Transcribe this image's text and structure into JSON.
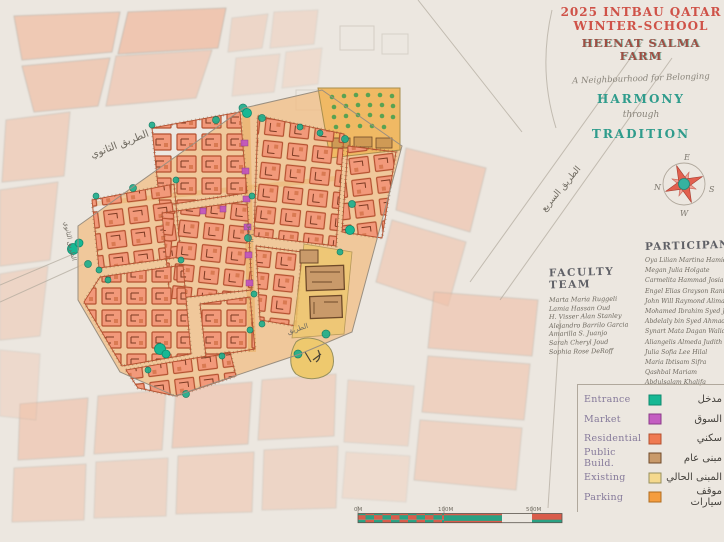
{
  "title_block": {
    "line1": "2025 INTBAU QATAR",
    "line2": "WINTER-SCHOOL",
    "line3": "HEENAT SALMA FARM",
    "dedication": "A Neighbourhood for Belonging",
    "harmony": "HARMONY",
    "through": "through",
    "tradition": "TRADITION"
  },
  "compass": {
    "n": "N",
    "e": "E",
    "s": "S",
    "w": "W"
  },
  "faculty_team": {
    "heading": "FACULTY TEAM",
    "names": [
      "Marta Maria Ruggeli",
      "Lamia Hassan Oud",
      "H. Visser Alan Stanley",
      "Alejandro Barrilo Garcia",
      "Amarilla S. Juanjo",
      "Sarah Cheryl Joud",
      "Sophia Rose DeRoff"
    ]
  },
  "participants": {
    "heading": "PARTICIPANTS",
    "names": [
      "Oya Lilian Martina Hamida",
      "Megan Julia Holgate",
      "Carmelita Hammad Josiane",
      "Engel Elias Grayson Rania",
      "John Will Raymond Alimara",
      "Mohamed Ibrahim Syed Jamil",
      "Abdelaly bin Syed Ahmad",
      "Synart Mata Dagan Walid",
      "Aliangelis Almeda Judith",
      "Julia Sofia Lee Hilal",
      "Maria Ibtisam Sifra",
      "Qashbal Mariam",
      "Abdulsalam Khalifa"
    ]
  },
  "legend": {
    "items": [
      {
        "label": "Entrance",
        "arabic": "مدخل",
        "color": "#17b894"
      },
      {
        "label": "Market",
        "arabic": "السوق",
        "color": "#c45ec2"
      },
      {
        "label": "Residential",
        "arabic": "سكني",
        "color": "#ef7a52"
      },
      {
        "label": "Public Build.",
        "arabic": "مبنى عام",
        "color": "#c99a6a"
      },
      {
        "label": "Existing",
        "arabic": "المبنى الحالي",
        "color": "#f5d98d"
      },
      {
        "label": "Parking",
        "arabic": "موقف سيارات",
        "color": "#f59d3f"
      }
    ]
  },
  "map_labels": {
    "road_top": "الطريق الثانوي",
    "road_right": "الطريق السريع",
    "road_left": "الطريق الثانوي",
    "road_center": "الطريق",
    "road_bottom": "الطريق"
  },
  "scale_bar": {
    "labels": [
      "0M",
      "100M",
      "500M"
    ]
  },
  "colors": {
    "paper": "#ece7e0",
    "context_wash": "#f0bfa6",
    "residential": "#f2997a",
    "residential_outline": "#b4502f",
    "street_wash": "#f3c98f",
    "existing_yellow": "#f0b964",
    "tree_green": "#1fae8c",
    "market_magenta": "#c156bc",
    "title_red": "#cf5248",
    "title_teal": "#2f9c8c",
    "pencil": "#8f8a80"
  }
}
